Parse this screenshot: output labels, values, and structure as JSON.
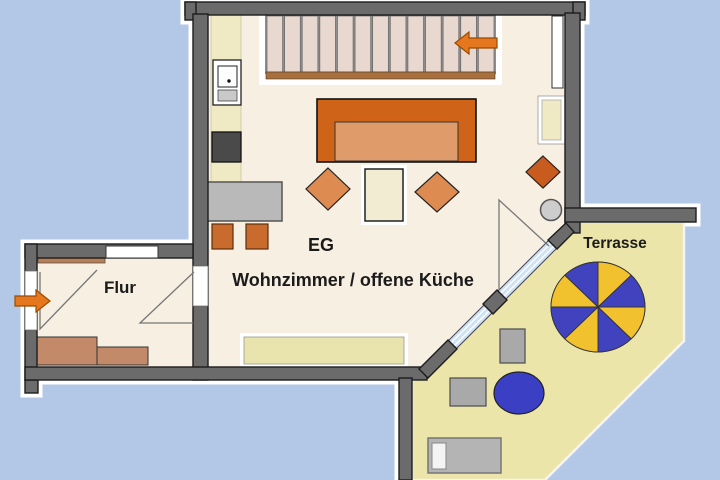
{
  "labels": {
    "floor_level": "EG",
    "living_room": "Wohnzimmer / offene Küche",
    "hallway": "Flur",
    "terrace": "Terrasse"
  },
  "stairs": {
    "tread_count": 13,
    "arrow_direction": "left"
  },
  "entrance": {
    "arrow_direction": "right"
  },
  "parasol": {
    "wedge_count": 8,
    "wedge_colors": [
      "#f2c12e",
      "#4043bd"
    ]
  },
  "colors": {
    "background": "#b3c7e6",
    "wall": "#6b6b6b",
    "room_floor": "#f6efe2",
    "terrace_floor": "#ebe5a9",
    "kitchen_counter": "#efe9c4",
    "sofa": "#cf6418",
    "sofa_seat": "#e09b6a",
    "cushion_orange": "#dd8b50",
    "cushion_dark_orange": "#c85b1e",
    "stool_orange": "#c96b2c",
    "arrow_orange": "#e5781e",
    "glazing_blue": "#cfe2f3",
    "furniture_gray": "#b9b9b9",
    "stove_gray": "#4a4a4a",
    "hall_furniture_brown": "#c28a68",
    "shelf_brown": "#b97e52",
    "stair_tread": "#e9d8cf",
    "stair_edge_brown": "#a9703d",
    "pale_yellow": "#e9e3ae",
    "table_blue": "#3b3fc4"
  }
}
